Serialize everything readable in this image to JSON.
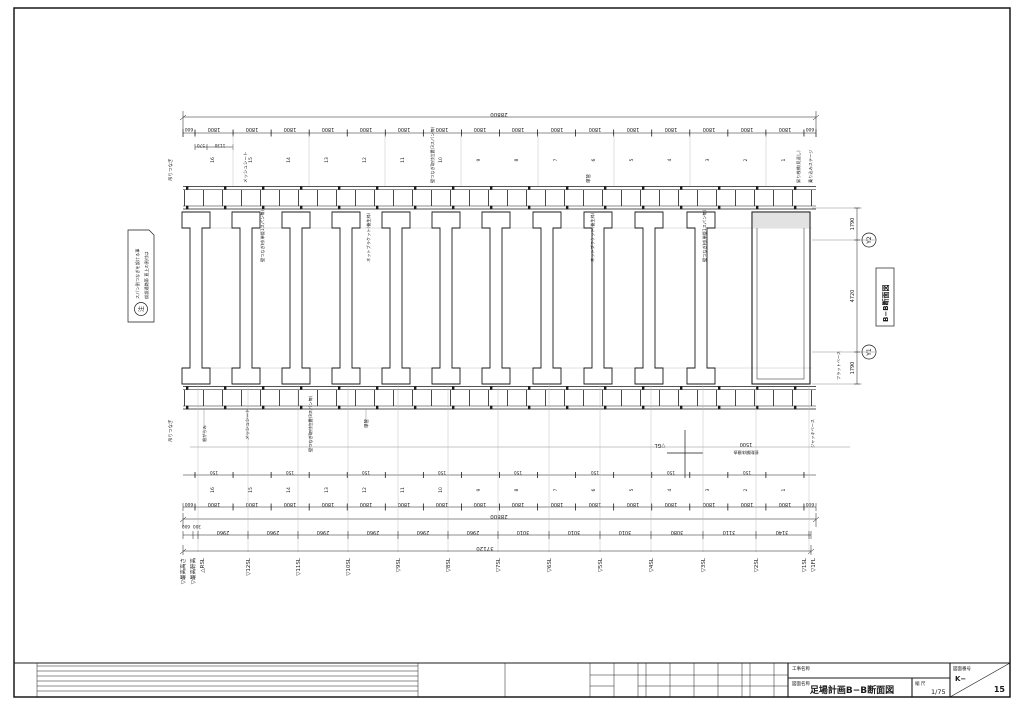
{
  "drawing": {
    "note": {
      "mark": "注",
      "line1": "仮設通路帯 直上の割付は",
      "line2": "スパン割つなぎを設ける事"
    },
    "section_box_label": "B−B断面図",
    "grid_bubbles": {
      "top": "Y2",
      "bottom": "Y1"
    },
    "right_dims": {
      "top": "1790",
      "middle": "4720",
      "bottom": "1790"
    },
    "top_chain": {
      "total": "28800",
      "end_left": "600",
      "end_right": "600",
      "bay": "1800",
      "sub1": "570",
      "sub2": "1130",
      "bay_numbers": [
        "16",
        "15",
        "14",
        "13",
        "12",
        "11",
        "10",
        "9",
        "8",
        "7",
        "6",
        "5",
        "4",
        "3",
        "2",
        "1"
      ]
    },
    "bottom_chain": {
      "total": "28800",
      "end_left": "600",
      "end_right": "600",
      "bay": "1800",
      "tie_offset": "150",
      "bay_numbers": [
        "16",
        "15",
        "14",
        "13",
        "12",
        "11",
        "10",
        "9",
        "8",
        "7",
        "6",
        "5",
        "4",
        "3",
        "2",
        "1"
      ]
    },
    "levels": {
      "total": "37120",
      "values": [
        "600",
        "300",
        "2960",
        "2960",
        "2960",
        "2960",
        "2960",
        "2960",
        "3010",
        "3010",
        "3010",
        "3080",
        "3110",
        "3140",
        "100"
      ],
      "labels": [
        "▽最高高さ",
        "▽最高軒高",
        "△RSL",
        "▽12SL",
        "▽11SL",
        "▽10SL",
        "▽9SL",
        "▽8SL",
        "▽7SL",
        "▽6SL",
        "▽5SL",
        "▽4SL",
        "▽3SL",
        "▽2SL",
        "▽1SL",
        "▽1FL"
      ]
    },
    "ground": {
      "gl_label": "▽GL",
      "excavation_depth": "1500",
      "excavation_note": "掘削解体撤去"
    },
    "annotations": {
      "top_left_tie": "吊りつなぎ",
      "bottom_left_tie": "吊りつなぎ",
      "mesh_sheet": "メッシュシート",
      "wall_tie_position": "壁つなぎ取付位置(3スパン毎)",
      "single_pipe": "単管",
      "stair_landing": "昇り桟橋(見返し)",
      "boarding_stage": "乗り込みステージ",
      "wall_tie_member": "壁つなぎ材(単管1スパン毎)",
      "net_bracket": "ネットブラケット(養生枠)",
      "jack_base": "ジャッキベース",
      "flat_base": "フラットベース",
      "base_tie": "根がらみ"
    }
  },
  "titleblock": {
    "project_label": "工事名称",
    "drawing_label": "図面名称",
    "title": "足場計画B−B断面図",
    "scale_label": "縮 尺",
    "scale_value": "1/75",
    "number_label": "図面番号",
    "number_prefix": "K−",
    "number_value": "15"
  }
}
